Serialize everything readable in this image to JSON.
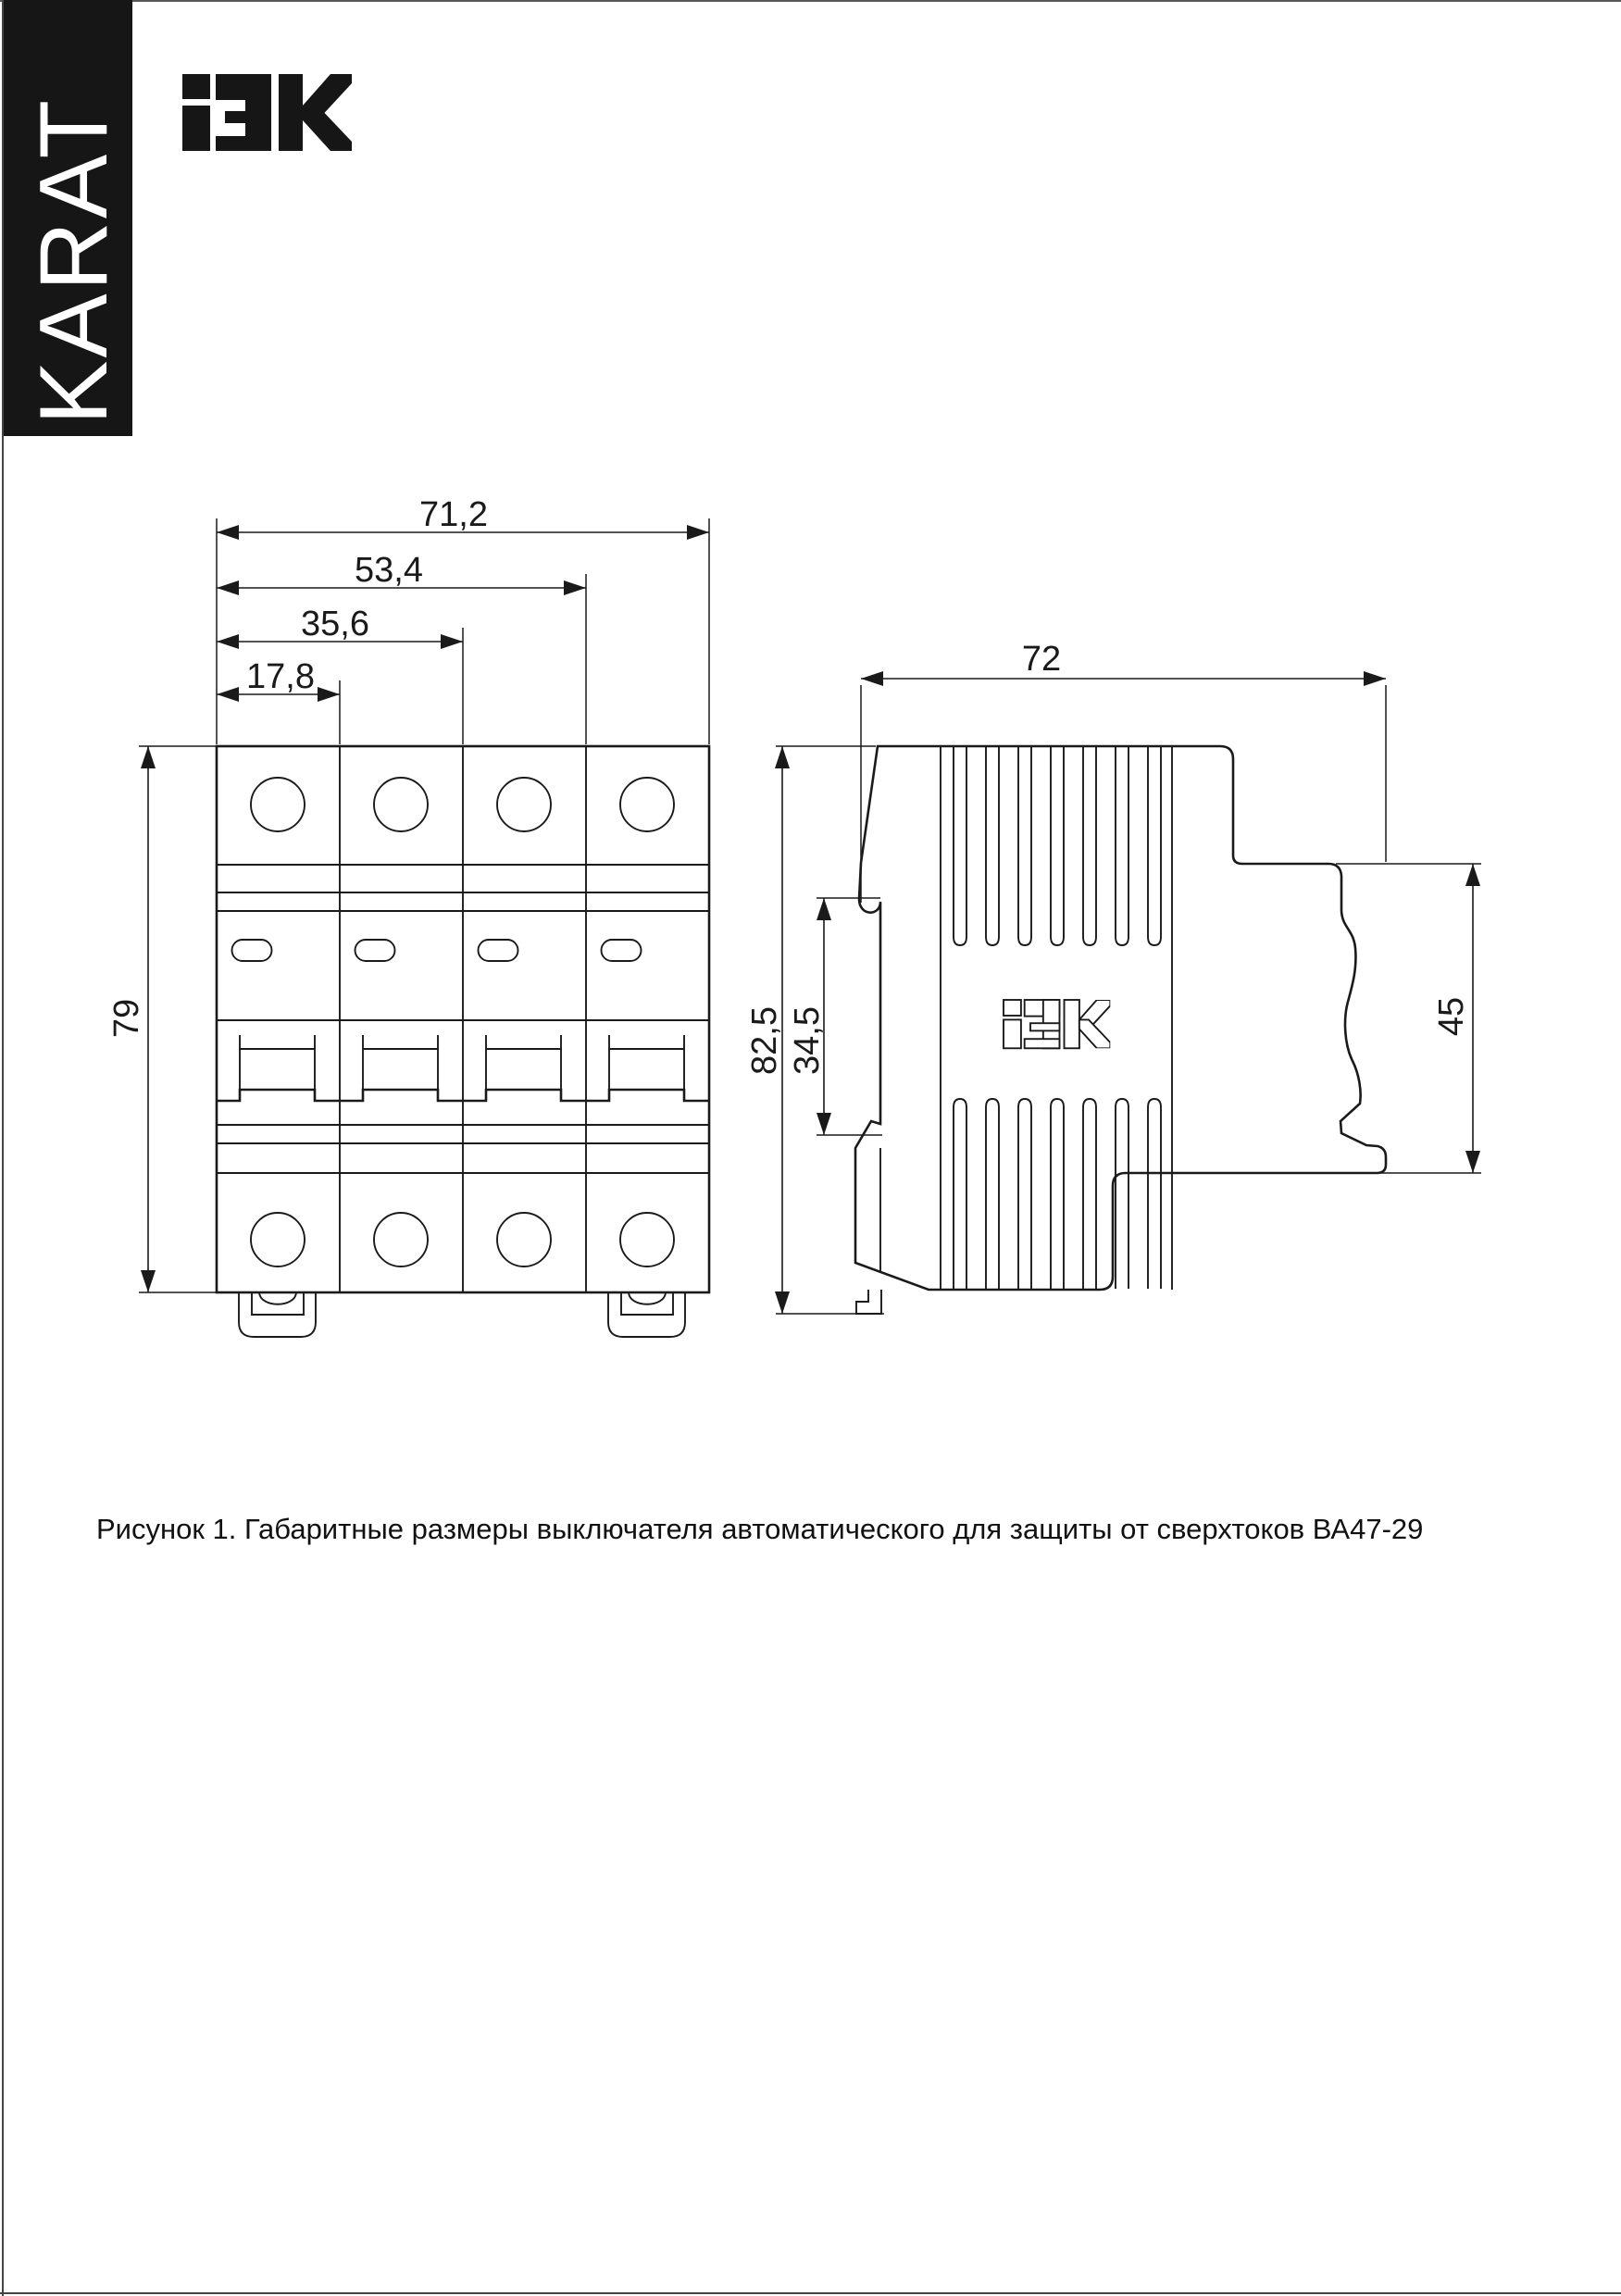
{
  "colors": {
    "background": "#ffffff",
    "ink": "#1a1a1a",
    "banner_background": "#161616",
    "banner_text_color": "#ffffff"
  },
  "banner": {
    "text": "KARAT"
  },
  "header": {
    "logo_text": "IEK"
  },
  "drawing": {
    "front_view": {
      "name": "front view of 4-pole circuit breaker",
      "dims": {
        "total_width": "71,2",
        "three_modules_width": "53,4",
        "two_modules_width": "35,6",
        "one_module_width": "17,8",
        "height": "79"
      }
    },
    "side_view": {
      "name": "side view of circuit breaker",
      "logo_text": "IEK",
      "dims": {
        "depth": "72",
        "total_height": "82,5",
        "din_slot_height": "34,5",
        "terminal_face_height": "45"
      }
    }
  },
  "figure": {
    "caption": "Рисунок 1. Габаритные размеры выключателя автоматического для защиты от сверхтоков ВА47-29"
  }
}
